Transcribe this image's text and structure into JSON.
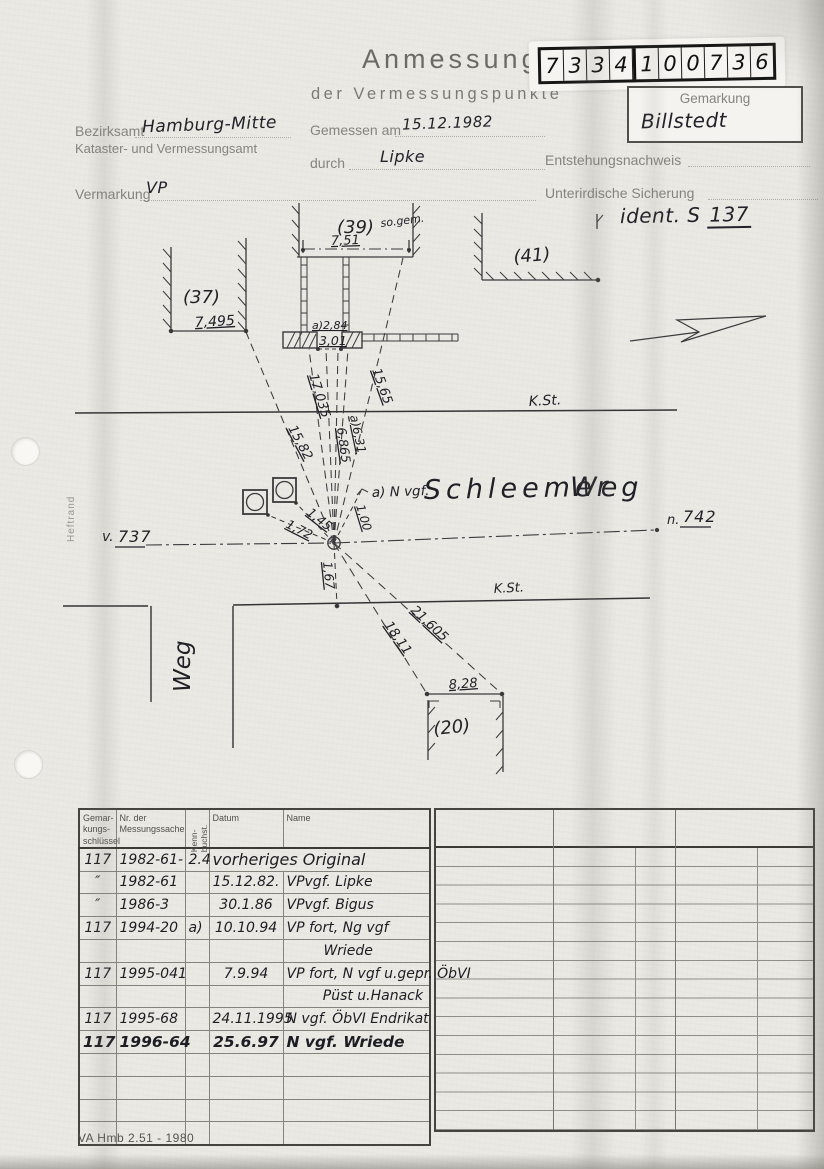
{
  "header": {
    "title": "Anmessung",
    "subtitle": "der Vermessungspunkte",
    "digits": [
      "7",
      "3",
      "3",
      "4",
      "1",
      "0",
      "0",
      "7",
      "3",
      "6"
    ],
    "gemarkung_label": "Gemarkung",
    "gemarkung_value": "Billstedt"
  },
  "form": {
    "bezirksamt_label": "Bezirksamt",
    "bezirksamt_value": "Hamburg-Mitte",
    "amt_line2": "Kataster- und Vermessungsamt",
    "gemessen_label": "Gemessen am",
    "gemessen_value": "15.12.1982",
    "durch_label": "durch",
    "durch_value": "Lipke",
    "entstehung_label": "Entstehungsnachweis",
    "vermarkung_label": "Vermarkung",
    "vermarkung_value": "VP",
    "sicherung_label": "Unterirdische Sicherung",
    "ident_label": "ident. S",
    "ident_number": "137",
    "heftrand": "Heftrand"
  },
  "sketch": {
    "labels": {
      "b37": "(37)",
      "b37_dim": "7,495",
      "b39": "(39)",
      "b39_sogem": "so.gem.",
      "b39_dim": "7,51",
      "b41": "(41)",
      "wall_a": "a)2,84",
      "wall_b": "3,01",
      "kst_upper": "K.St.",
      "kst_lower": "K.St.",
      "v_prefix": "v.",
      "v_num": "737",
      "n_prefix": "n.",
      "n_num": "742",
      "r1582": "15,82",
      "r17035": "17,035",
      "r6865": "6,865",
      "ra631": "a)6,31",
      "r1565": "15,65",
      "r145": "1,45",
      "r172": "1,72",
      "r100": "1,00",
      "r167": "1,67",
      "r1811": "18,11",
      "r21605": "21,605",
      "nvgf": "a) N vgf.",
      "street1": "Schleemer",
      "street2": "Weg",
      "road": "Weg",
      "b20": "(20)",
      "b20_dim": "8,28"
    }
  },
  "table": {
    "headers": {
      "col1": "Gemar-\nkungs-\nschlüssel",
      "col2": "Nr. der\nMessungssache",
      "col3": "Kenn-\nbuchst.",
      "col4": "Datum",
      "col5": "Name"
    },
    "rows": [
      {
        "c1": "117",
        "c2": "1982-61-",
        "c3": "2.4",
        "c4": "vorheriges Original",
        "c5": "",
        "span": true
      },
      {
        "c1": "″",
        "c2": "1982-61",
        "c3": "",
        "c4": "15.12.82.",
        "c5": "VPvgf. Lipke"
      },
      {
        "c1": "″",
        "c2": "1986-3",
        "c3": "",
        "c4": "30.1.86",
        "c5": "VPvgf. Bigus"
      },
      {
        "c1": "117",
        "c2": "1994-20",
        "c3": "a)",
        "c4": "10.10.94",
        "c5": "VP fort, Ng vgf"
      },
      {
        "c1": "",
        "c2": "",
        "c3": "",
        "c4": "",
        "c5": "Wriede",
        "indent": true
      },
      {
        "c1": "117",
        "c2": "1995-041",
        "c3": "",
        "c4": "7.9.94",
        "c5": "VP fort, N vgf u.gepr. ÖbVI"
      },
      {
        "c1": "",
        "c2": "",
        "c3": "",
        "c4": "",
        "c5": "Püst u.Hanack",
        "right": true
      },
      {
        "c1": "117",
        "c2": "1995-68",
        "c3": "",
        "c4": "24.11.1995",
        "c5": "N vgf. ÖbVI Endrikat"
      },
      {
        "c1": "117",
        "c2": "1996-64",
        "c3": "",
        "c4": "25.6.97",
        "c5": "N vgf. Wriede",
        "bold": true
      },
      {},
      {},
      {},
      {}
    ]
  },
  "footer": {
    "form_code": "VA Hmb 2.51 - 1980"
  }
}
